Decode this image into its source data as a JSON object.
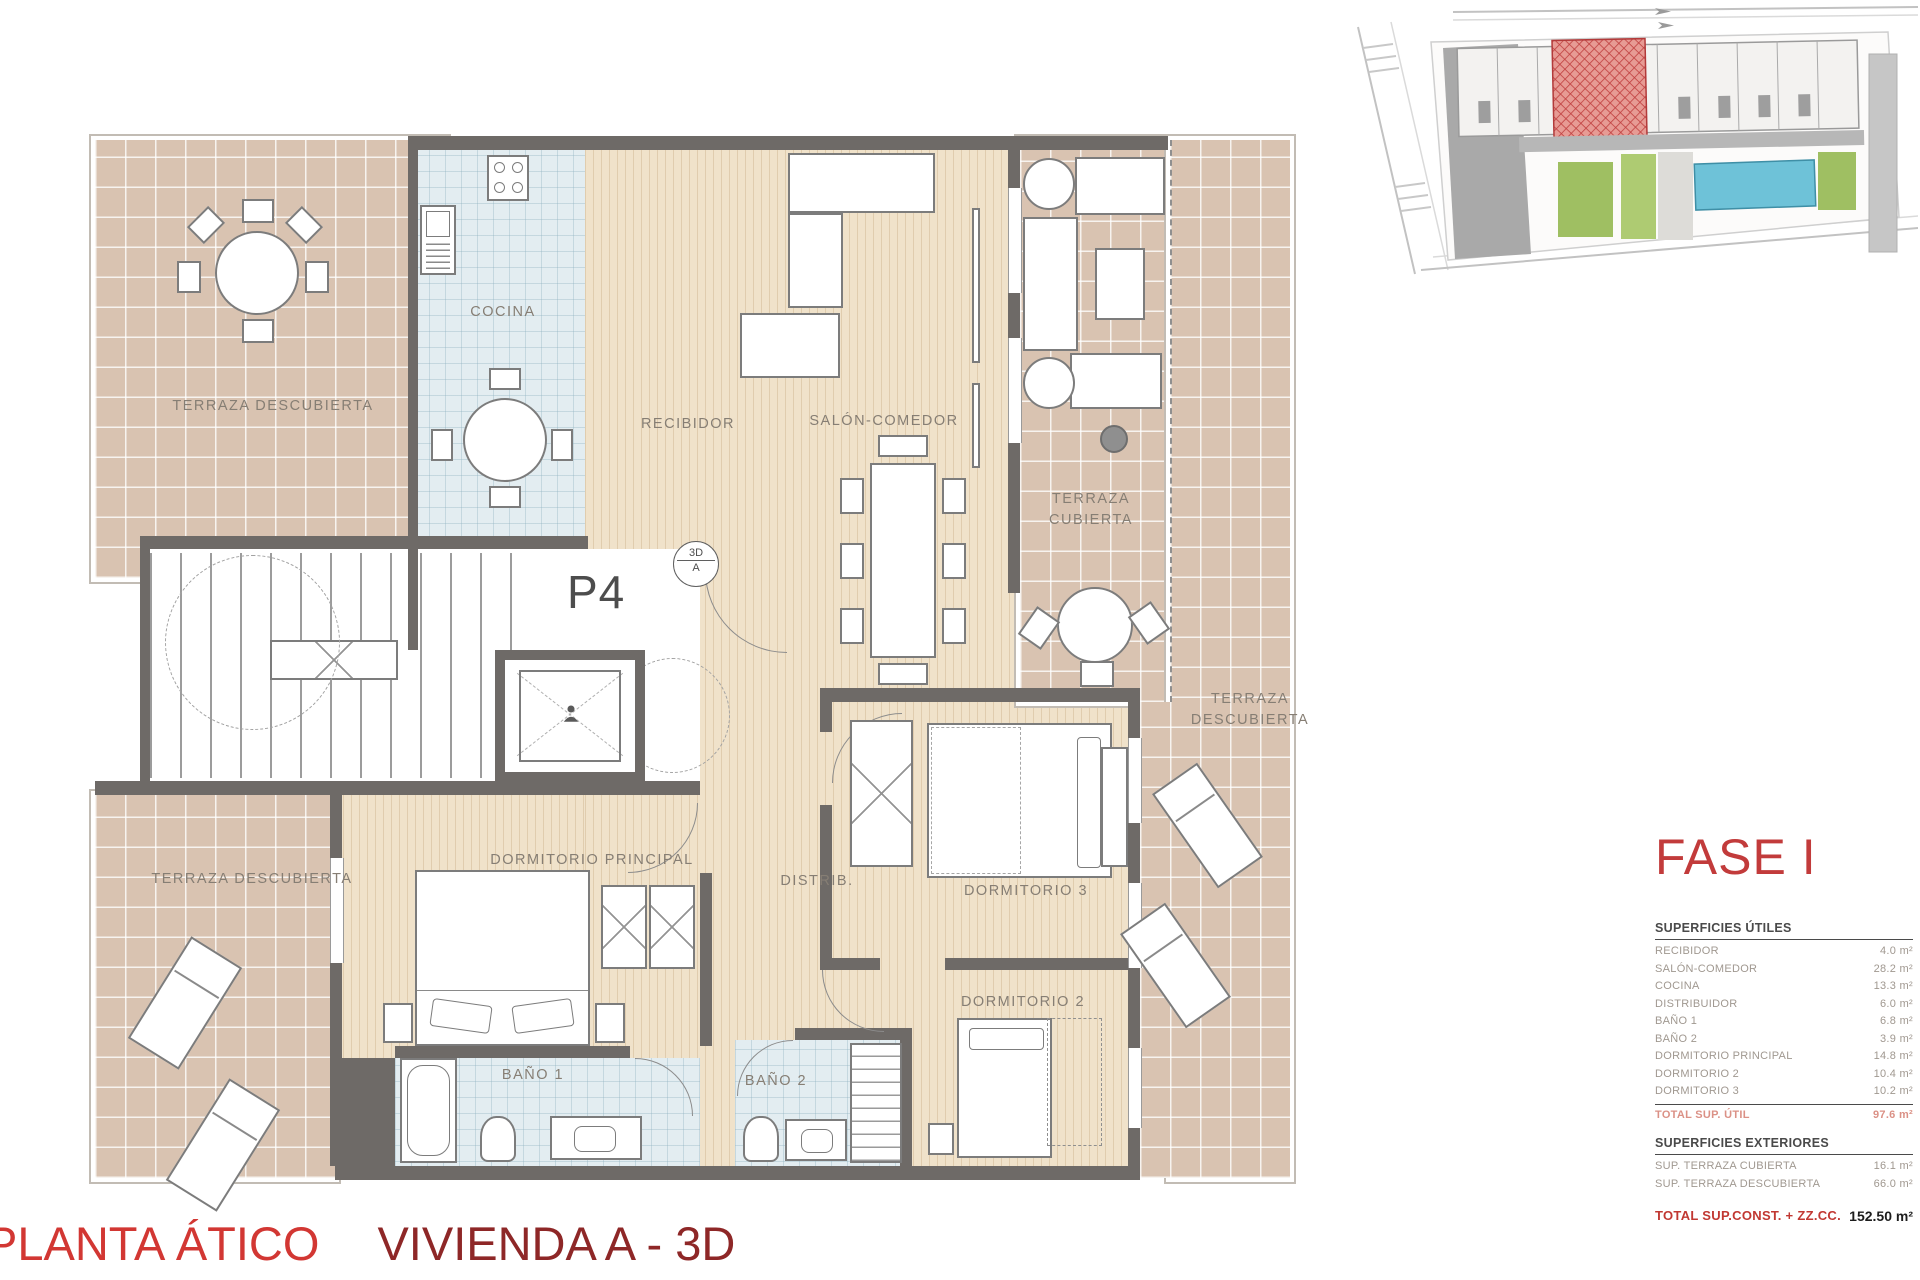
{
  "title": {
    "left": "PLANTA ÁTICO",
    "right": "VIVIENDA A - 3D"
  },
  "phase": "FASE I",
  "plan": {
    "unit": "P4",
    "marker": {
      "top": "3D",
      "bottom": "A"
    },
    "rooms": {
      "terraza_tl": "TERRAZA DESCUBIERTA",
      "cocina": "COCINA",
      "recibidor": "RECIBIDOR",
      "salon": "SALÓN-COMEDOR",
      "terraza_cubierta_l1": "TERRAZA",
      "terraza_cubierta_l2": "CUBIERTA",
      "terraza_der_l1": "TERRAZA",
      "terraza_der_l2": "DESCUBIERTA",
      "dormitorio_principal": "DORMITORIO PRINCIPAL",
      "distribuidor": "DISTRIB.",
      "dormitorio_3": "DORMITORIO 3",
      "dormitorio_2": "DORMITORIO 2",
      "bano_1": "BAÑO 1",
      "bano_2": "BAÑO 2",
      "terraza_bl": "TERRAZA DESCUBIERTA"
    }
  },
  "tables": {
    "utiles": {
      "header": "SUPERFICIES ÚTILES",
      "rows": [
        {
          "label": "RECIBIDOR",
          "value": "4.0 m²"
        },
        {
          "label": "SALÓN-COMEDOR",
          "value": "28.2 m²"
        },
        {
          "label": "COCINA",
          "value": "13.3 m²"
        },
        {
          "label": "DISTRIBUIDOR",
          "value": "6.0 m²"
        },
        {
          "label": "BAÑO 1",
          "value": "6.8 m²"
        },
        {
          "label": "BAÑO 2",
          "value": "3.9 m²"
        },
        {
          "label": "DORMITORIO PRINCIPAL",
          "value": "14.8 m²"
        },
        {
          "label": "DORMITORIO 2",
          "value": "10.4 m²"
        },
        {
          "label": "DORMITORIO 3",
          "value": "10.2 m²"
        }
      ],
      "total": {
        "label": "TOTAL SUP. ÚTIL",
        "value": "97.6 m²"
      }
    },
    "exteriores": {
      "header": "SUPERFICIES EXTERIORES",
      "rows": [
        {
          "label": "SUP. TERRAZA CUBIERTA",
          "value": "16.1 m²"
        },
        {
          "label": "SUP. TERRAZA DESCUBIERTA",
          "value": "66.0 m²"
        }
      ]
    },
    "total_const": {
      "label": "TOTAL SUP.CONST. + ZZ.CC.",
      "value": "152.50 m²"
    }
  },
  "colors": {
    "accent_red": "#c23b3b",
    "title_red": "#d23733",
    "title_maroon": "#8e2727",
    "wall_gray": "#6e6a67",
    "terrace_tile": "#d9c3b1",
    "wood_floor": "#f0e2ca",
    "wet_tile": "#e3edf1",
    "label_gray": "#867e74",
    "highlight_unit_red": "#c04040",
    "pool_blue": "#6ec2d8",
    "landscape_green": "#9fbf62"
  }
}
